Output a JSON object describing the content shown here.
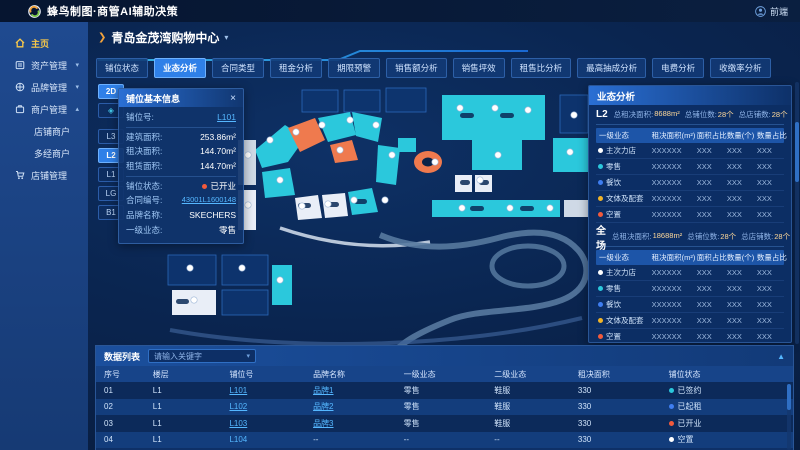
{
  "header": {
    "title": "蜂鸟制图·商管AI辅助决策",
    "user": "前端"
  },
  "colors": {
    "accent": "#2f80e8",
    "link": "#55b7ff",
    "teal": "#2bc8dc",
    "orange": "#ef7a4e",
    "red": "#f25a3c",
    "yellow": "#f0b429",
    "blue": "#3f7ef0",
    "white_shape": "#e9eef7",
    "dark_unit": "#0e3570",
    "road": "#56799f"
  },
  "sidebar": {
    "items": {
      "home": "主页",
      "asset": "资产管理",
      "brand": "品牌管理",
      "merchant": "商户管理",
      "merchant_shop": "店铺商户",
      "merchant_multi": "多经商户",
      "shop_mgmt": "店铺管理"
    }
  },
  "mall": {
    "name": "青岛金茂湾购物中心"
  },
  "tabs": [
    {
      "label": "铺位状态"
    },
    {
      "label": "业态分析",
      "active": true
    },
    {
      "label": "合同类型"
    },
    {
      "label": "租金分析"
    },
    {
      "label": "期限预警"
    },
    {
      "label": "销售额分析"
    },
    {
      "label": "销售坪效"
    },
    {
      "label": "租售比分析"
    },
    {
      "label": "最高抽成分析"
    },
    {
      "label": "电费分析"
    },
    {
      "label": "收缴率分析"
    }
  ],
  "floors": {
    "view_2d": "2D",
    "levels": [
      {
        "label": "L3"
      },
      {
        "label": "L2",
        "active": true
      },
      {
        "label": "L1"
      },
      {
        "label": "LG"
      },
      {
        "label": "B1"
      }
    ]
  },
  "shop_info": {
    "title": "铺位基本信息",
    "shop_no": {
      "label": "铺位号:",
      "value": "L101"
    },
    "build_area": {
      "label": "建筑面积:",
      "value": "253.86m²"
    },
    "lease_plan": {
      "label": "租决面积:",
      "value": "144.70m²"
    },
    "lease_area": {
      "label": "租赁面积:",
      "value": "144.70m²"
    },
    "status": {
      "label": "铺位状态:",
      "value": "已开业",
      "dot": "#f25a3c"
    },
    "contract": {
      "label": "合同编号:",
      "value": "43001L1600148"
    },
    "brand": {
      "label": "品牌名称:",
      "value": "SKECHERS"
    },
    "category": {
      "label": "一级业态:",
      "value": "零售"
    }
  },
  "analysis": {
    "title": "业态分析",
    "table_headers": [
      "一级业态",
      "租决面积(m²)",
      "面积占比",
      "数量(个)",
      "数量占比"
    ],
    "sections": [
      {
        "name": "L2",
        "area_label": "总租决面积:",
        "area": "8688m²",
        "slots_label": "总铺位数:",
        "slots": "28个",
        "shops_label": "总店铺数:",
        "shops": "28个",
        "rows": [
          {
            "name": "主次力店",
            "color": "#ffffff",
            "values": [
              "XXXXXX",
              "XXX",
              "XXX",
              "XXX"
            ]
          },
          {
            "name": "零售",
            "color": "#2bc8dc",
            "values": [
              "XXXXXX",
              "XXX",
              "XXX",
              "XXX"
            ]
          },
          {
            "name": "餐饮",
            "color": "#3f7ef0",
            "values": [
              "XXXXXX",
              "XXX",
              "XXX",
              "XXX"
            ]
          },
          {
            "name": "文体及配套",
            "color": "#f0b429",
            "values": [
              "XXXXXX",
              "XXX",
              "XXX",
              "XXX"
            ]
          },
          {
            "name": "空置",
            "color": "#f25a3c",
            "values": [
              "XXXXXX",
              "XXX",
              "XXX",
              "XXX"
            ]
          }
        ]
      },
      {
        "name": "全场",
        "area_label": "总租决面积:",
        "area": "18688m²",
        "slots_label": "总铺位数:",
        "slots": "28个",
        "shops_label": "总店铺数:",
        "shops": "28个",
        "rows": [
          {
            "name": "主次力店",
            "color": "#ffffff",
            "values": [
              "XXXXXX",
              "XXX",
              "XXX",
              "XXX"
            ]
          },
          {
            "name": "零售",
            "color": "#2bc8dc",
            "values": [
              "XXXXXX",
              "XXX",
              "XXX",
              "XXX"
            ]
          },
          {
            "name": "餐饮",
            "color": "#3f7ef0",
            "values": [
              "XXXXXX",
              "XXX",
              "XXX",
              "XXX"
            ]
          },
          {
            "name": "文体及配套",
            "color": "#f0b429",
            "values": [
              "XXXXXX",
              "XXX",
              "XXX",
              "XXX"
            ]
          },
          {
            "name": "空置",
            "color": "#f25a3c",
            "values": [
              "XXXXXX",
              "XXX",
              "XXX",
              "XXX"
            ]
          }
        ]
      }
    ]
  },
  "data_table": {
    "title": "数据列表",
    "filter_placeholder": "请输入关键字",
    "headers": [
      "序号",
      "楼层",
      "铺位号",
      "品牌名称",
      "一级业态",
      "二级业态",
      "租决面积",
      "铺位状态"
    ],
    "rows": [
      {
        "no": "01",
        "floor": "L1",
        "shop": "L101",
        "shop_link": true,
        "brand": "品牌1",
        "brand_link": true,
        "cat1": "零售",
        "cat2": "鞋服",
        "area": "330",
        "status": "已签约",
        "status_color": "#2bc8dc"
      },
      {
        "no": "02",
        "floor": "L1",
        "shop": "L102",
        "shop_link": true,
        "brand": "品牌2",
        "brand_link": true,
        "cat1": "零售",
        "cat2": "鞋服",
        "area": "330",
        "status": "已起租",
        "status_color": "#3f7ef0"
      },
      {
        "no": "03",
        "floor": "L1",
        "shop": "L103",
        "shop_link": true,
        "brand": "品牌3",
        "brand_link": true,
        "cat1": "零售",
        "cat2": "鞋服",
        "area": "330",
        "status": "已开业",
        "status_color": "#f25a3c"
      },
      {
        "no": "04",
        "floor": "L1",
        "shop": "L104",
        "brand": "--",
        "cat1": "--",
        "cat2": "--",
        "area": "330",
        "status": "空置",
        "status_color": "#ffffff"
      }
    ]
  }
}
